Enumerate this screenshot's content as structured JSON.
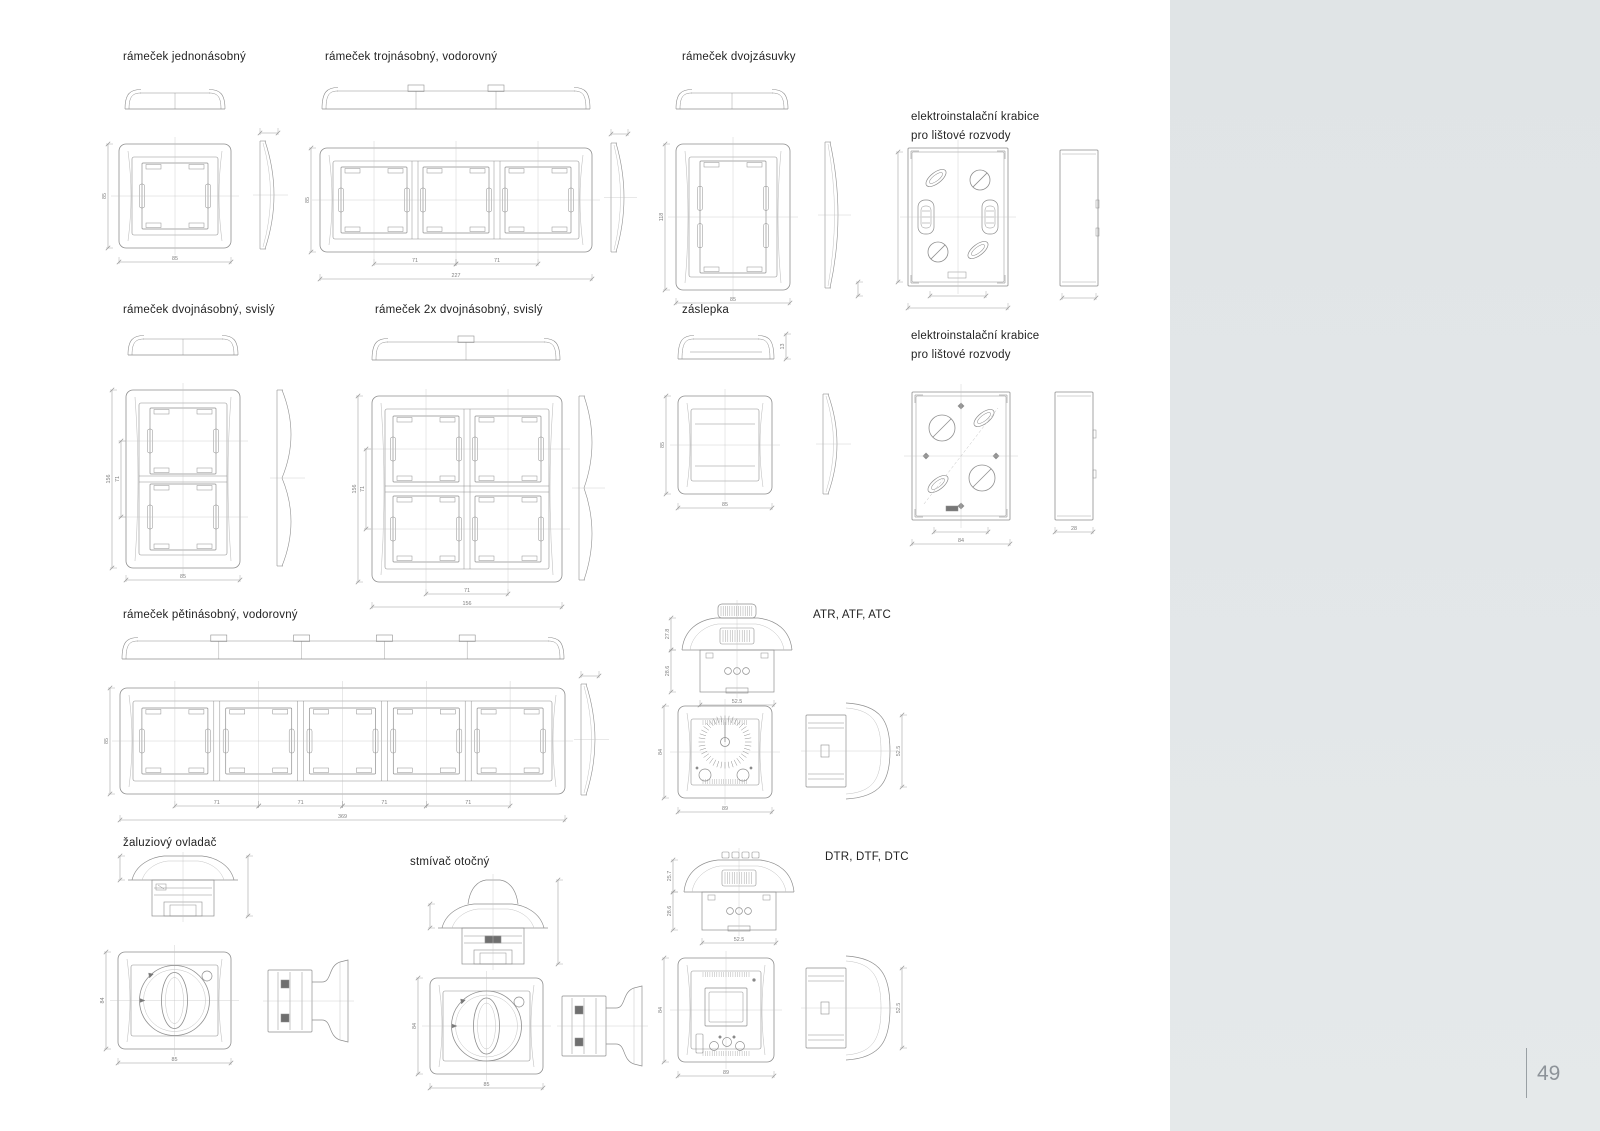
{
  "page": {
    "number": "49"
  },
  "colors": {
    "line": "#8f8f8f",
    "line_light": "#c2c2c2",
    "centerline": "#c4c4c4",
    "dim": "#9a9a9a",
    "dim_text": "#808080",
    "label": "#232323",
    "sidebar": "#e2e6e8",
    "page_number": "#8d9399"
  },
  "sections": [
    {
      "id": "single-frame",
      "label": "rámeček jednonásobný",
      "dims": {
        "width": "85",
        "height": "85"
      }
    },
    {
      "id": "triple-frame-horizontal",
      "label": "rámeček trojnásobný, vodorovný",
      "dims": {
        "height": "85",
        "pitch": "71",
        "width": "227"
      }
    },
    {
      "id": "double-socket-frame",
      "label": "rámeček dvojzásuvky",
      "dims": {
        "height": "118",
        "width": "85"
      }
    },
    {
      "id": "installation-box-top",
      "label_lines": [
        "elektroinstalační krabice",
        "pro lištové rozvody"
      ],
      "dims": {}
    },
    {
      "id": "double-frame-vertical",
      "label": "rámeček dvojnásobný, svislý",
      "dims": {
        "height": "156",
        "pitch": "71",
        "width": "85"
      }
    },
    {
      "id": "double-2x-frame-vertical",
      "label": "rámeček 2x dvojnásobný, svislý",
      "dims": {
        "height": "156",
        "pitch": "71",
        "width": "156"
      }
    },
    {
      "id": "blank-plate",
      "label": "záslepka",
      "dims": {
        "height": "85",
        "width": "85",
        "depth": "13"
      }
    },
    {
      "id": "installation-box-bottom",
      "label_lines": [
        "elektroinstalační krabice",
        "pro lištové rozvody"
      ],
      "dims": {
        "width": "84",
        "depth": "28"
      }
    },
    {
      "id": "five-frame-horizontal",
      "label": "rámeček pětinásobný, vodorovný",
      "dims": {
        "height": "85",
        "pitch": "71",
        "width": "369"
      }
    },
    {
      "id": "thermostat-analog",
      "label": "ATR, ATF, ATC",
      "dims": {
        "cap_height": "27.8",
        "body_height": "28.6",
        "body_width": "52.5",
        "front_height": "84",
        "front_width": "89",
        "side_depth": "52.5"
      }
    },
    {
      "id": "blind-controller",
      "label": "žaluziový ovladač",
      "dims": {
        "front_height": "84",
        "front_width": "85"
      }
    },
    {
      "id": "rotary-dimmer",
      "label": "stmívač otočný",
      "dims": {
        "front_height": "84",
        "front_width": "85"
      }
    },
    {
      "id": "thermostat-digital",
      "label": "DTR, DTF, DTC",
      "dims": {
        "cap_height": "25.7",
        "body_height": "28.6",
        "body_width": "52.5",
        "front_height": "84",
        "front_width": "89",
        "side_depth": "52.5"
      }
    }
  ]
}
